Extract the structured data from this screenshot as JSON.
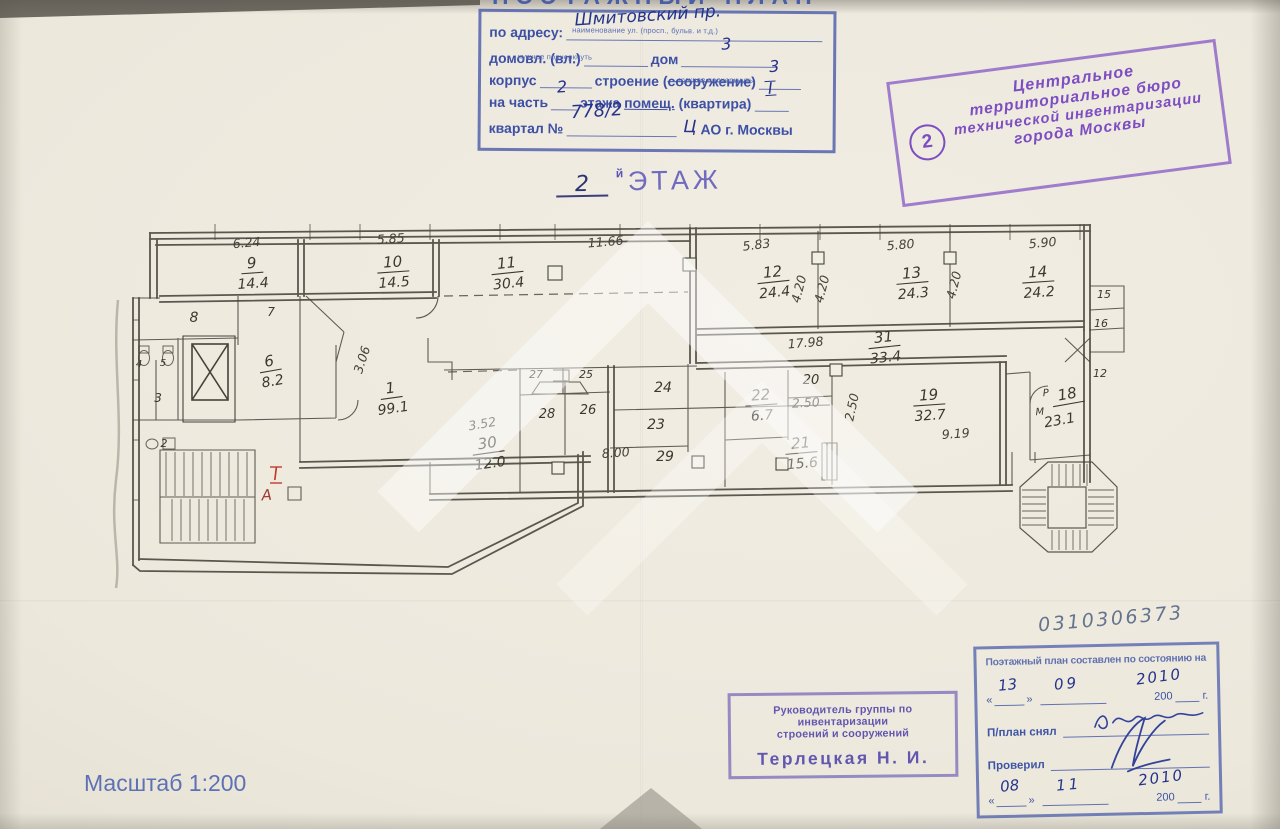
{
  "header_form": {
    "clipped_title": "ПОЭТАЖНЫЙ ПЛАН",
    "address_label": "по адресу:",
    "address_value": "Шмитовский пр.",
    "address_caption": "наименование ул. (просп., бульв. и т.д.)",
    "domovl_label": "домовл. (вл.)",
    "dom_label": "дом",
    "dom_value": "3",
    "underline_note": "нужное подчеркнуть",
    "korpus_label": "корпус",
    "stroenie_label": "строение (",
    "stroenie_struck": "сооружение",
    "stroenie_close": ")",
    "stroenie_value": "3",
    "chast_label": "на часть",
    "chast_value": "2",
    "etazha_label": "этажа",
    "pomesch_label": "помещ.",
    "kvartira_label": "(квартира)",
    "kvartira_value": "I",
    "kvartal_label": "квартал №",
    "kvartal_value": "778/2",
    "okrug_value": "Ц",
    "okrug_label": "АО г. Москвы"
  },
  "floor_title": {
    "number": "2",
    "suffix": "й",
    "word": "ЭТАЖ"
  },
  "bti_stamp": {
    "badge": "2",
    "lines": [
      "Центральное",
      "территориальное бюро",
      "технической инвентаризации",
      "города Москвы"
    ]
  },
  "plan": {
    "rooms": [
      {
        "n": "9",
        "a": "14.4",
        "x": 252,
        "y": 268,
        "r": -4
      },
      {
        "n": "10",
        "a": "14.5",
        "x": 393,
        "y": 267,
        "r": -4
      },
      {
        "n": "11",
        "a": "30.4",
        "x": 507,
        "y": 268,
        "r": -6
      },
      {
        "n": "12",
        "a": "24.4",
        "x": 773,
        "y": 277,
        "r": -6
      },
      {
        "n": "13",
        "a": "24.3",
        "x": 912,
        "y": 278,
        "r": -5
      },
      {
        "n": "14",
        "a": "24.2",
        "x": 1038,
        "y": 277,
        "r": -4
      },
      {
        "n": "31",
        "a": "33.4",
        "x": 884,
        "y": 342,
        "r": -6
      },
      {
        "n": "1",
        "a": "99.1",
        "x": 391,
        "y": 393,
        "r": -8
      },
      {
        "n": "30",
        "a": "12.0",
        "x": 488,
        "y": 448,
        "r": -8
      },
      {
        "n": "22",
        "a": "6.7",
        "x": 761,
        "y": 400,
        "r": -4
      },
      {
        "n": "21",
        "a": "15.6",
        "x": 801,
        "y": 448,
        "r": -5
      },
      {
        "n": "19",
        "a": "32.7",
        "x": 929,
        "y": 400,
        "r": -4
      },
      {
        "n": "18",
        "a": "23.1",
        "x": 1068,
        "y": 399,
        "r": -10,
        "ax": -12,
        "ay": 24
      },
      {
        "n": "6",
        "a": "8.2",
        "x": 270,
        "y": 366,
        "r": -10
      },
      {
        "n": "20",
        "x": 811,
        "y": 384,
        "s": 13
      },
      {
        "n": "23",
        "x": 656,
        "y": 429,
        "s": 14
      },
      {
        "n": "24",
        "x": 663,
        "y": 392,
        "s": 14
      },
      {
        "n": "26",
        "x": 588,
        "y": 414,
        "s": 13
      },
      {
        "n": "28",
        "x": 547,
        "y": 418,
        "s": 13
      },
      {
        "n": "27",
        "x": 536,
        "y": 378,
        "s": 11
      },
      {
        "n": "25",
        "x": 586,
        "y": 378,
        "s": 11
      },
      {
        "n": "29",
        "x": 665,
        "y": 461,
        "s": 14
      },
      {
        "n": "8",
        "x": 194,
        "y": 322,
        "s": 14
      },
      {
        "n": "7",
        "x": 271,
        "y": 316,
        "s": 12
      },
      {
        "n": "5",
        "x": 163,
        "y": 366,
        "s": 10
      },
      {
        "n": "4",
        "x": 139,
        "y": 367,
        "s": 10
      },
      {
        "n": "3",
        "x": 158,
        "y": 402,
        "s": 12
      },
      {
        "n": "2",
        "x": 164,
        "y": 447,
        "s": 11
      },
      {
        "n": "15",
        "x": 1104,
        "y": 298,
        "s": 11
      },
      {
        "n": "16",
        "x": 1101,
        "y": 327,
        "s": 11
      },
      {
        "n": "12",
        "x": 1100,
        "y": 377,
        "s": 11
      }
    ],
    "dims": [
      {
        "t": "6.24",
        "x": 247,
        "y": 247,
        "r": -5
      },
      {
        "t": "5.85",
        "x": 391,
        "y": 243,
        "r": -4
      },
      {
        "t": "11.66",
        "x": 606,
        "y": 246,
        "r": -5
      },
      {
        "t": "5.83",
        "x": 757,
        "y": 249,
        "r": -7
      },
      {
        "t": "5.80",
        "x": 901,
        "y": 249,
        "r": -5
      },
      {
        "t": "5.90",
        "x": 1043,
        "y": 247,
        "r": -5
      },
      {
        "t": "17.98",
        "x": 806,
        "y": 347,
        "r": -5
      },
      {
        "t": "9.19",
        "x": 956,
        "y": 438,
        "r": -4
      },
      {
        "t": "8.00",
        "x": 616,
        "y": 457,
        "r": -4
      },
      {
        "t": "3.52",
        "x": 483,
        "y": 428,
        "r": -10
      },
      {
        "t": "2.50",
        "x": 806,
        "y": 407,
        "r": -3
      },
      {
        "t": "2.50",
        "x": 856,
        "y": 408,
        "r": -78
      },
      {
        "t": "4.20",
        "x": 803,
        "y": 290,
        "r": -76
      },
      {
        "t": "4.20",
        "x": 826,
        "y": 290,
        "r": -76
      },
      {
        "t": "4.20",
        "x": 958,
        "y": 286,
        "r": -76
      },
      {
        "t": "3.06",
        "x": 366,
        "y": 361,
        "r": -72
      }
    ],
    "marks": [
      {
        "t": "I",
        "x": 276,
        "y": 480,
        "c": "red",
        "s": 17,
        "serif": true
      },
      {
        "t": "А",
        "x": 267,
        "y": 500,
        "c": "red2",
        "s": 15
      },
      {
        "t": "М",
        "x": 1040,
        "y": 415,
        "c": "ink",
        "s": 10
      },
      {
        "t": "Р",
        "x": 1046,
        "y": 396,
        "c": "ink",
        "s": 10
      }
    ]
  },
  "inventory_number": "0310306373",
  "date_stamp": {
    "title": "Поэтажный план составлен по состоянию на",
    "quote_open": "«",
    "quote_close": "»",
    "row1": {
      "day": "13",
      "month": "09",
      "year_hw": "2010",
      "year_print": "200",
      "year_suffix": "г."
    },
    "snyal_label": "П/план снял",
    "proveril_label": "Проверил",
    "row2": {
      "day": "08",
      "month": "11",
      "year_hw": "2010",
      "year_print": "200",
      "year_suffix": "г."
    }
  },
  "head_stamp": {
    "line1": "Руководитель группы по инвентаризации",
    "line2": "строений и сооружений",
    "name": "Терлецкая Н. И."
  },
  "scale_label": "Масштаб 1:200",
  "colors": {
    "form_blue": "#3e54a6",
    "hand_ink_blue": "#25338c",
    "stamp_purple": "#7440c0",
    "head_violet": "#5b4fae",
    "plan_ink": "#3b3831",
    "dim_ink": "#45423a",
    "red": "#c23a2c",
    "red2": "#a03a30",
    "ink": "#3b3831",
    "gray_blue": "#64748f"
  }
}
